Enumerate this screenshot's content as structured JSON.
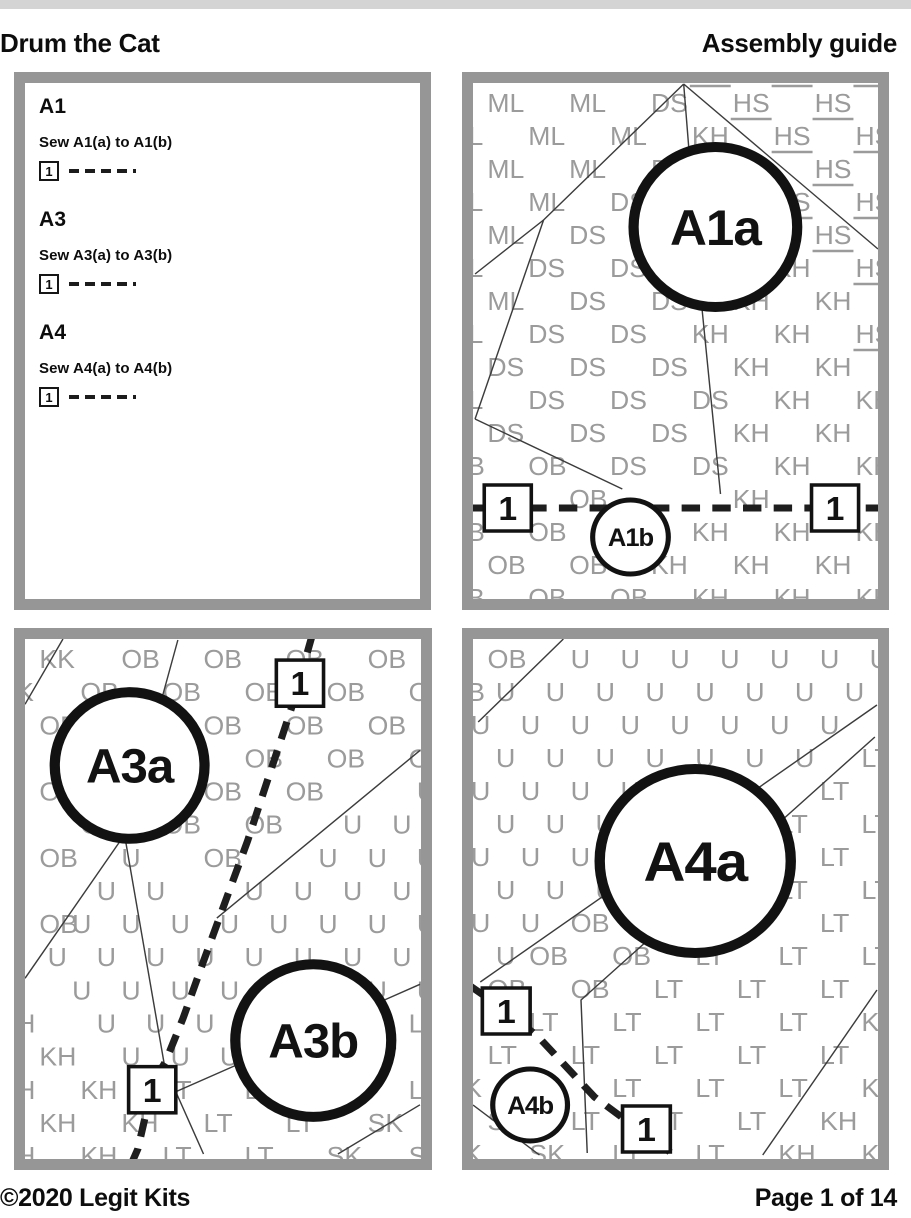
{
  "header": {
    "title": "Drum the Cat",
    "subtitle": "Assembly guide"
  },
  "footer": {
    "copyright": "©2020 Legit Kits",
    "page_indicator": "Page 1 of 14"
  },
  "colors": {
    "panel_border_gray": "#969696",
    "fabric_code_gray": "#9b9b9b",
    "seam_black": "#1e1e1e",
    "top_bar_gray": "#d4d4d4",
    "text_black": "#0d0d0d"
  },
  "instruction_panel": {
    "steps": [
      {
        "title": "A1",
        "text": "Sew A1(a) to A1(b)",
        "seam_number": "1"
      },
      {
        "title": "A3",
        "text": "Sew A3(a) to A3(b)",
        "seam_number": "1"
      },
      {
        "title": "A4",
        "text": "Sew A4(a) to A4(b)",
        "seam_number": "1"
      }
    ]
  },
  "pattern_panels": [
    {
      "id": "A1",
      "view": {
        "w": 396,
        "h": 516
      },
      "regions": [
        {
          "code": "ML",
          "underline": false,
          "poly": [
            [
              -20,
              -20
            ],
            [
              210,
              -20
            ],
            [
              206,
              1
            ],
            [
              69,
              137
            ],
            [
              0,
              336
            ],
            [
              -20,
              336
            ]
          ]
        },
        {
          "code": "DS",
          "underline": false,
          "poly": [
            [
              206,
              1
            ],
            [
              222,
              206
            ],
            [
              242,
              411
            ],
            [
              146,
              406
            ],
            [
              2,
              336
            ],
            [
              69,
              137
            ]
          ]
        },
        {
          "code": "HS",
          "underline": true,
          "poly": [
            [
              206,
              -20
            ],
            [
              416,
              -20
            ],
            [
              416,
              300
            ]
          ]
        },
        {
          "code": "KH",
          "underline": false,
          "poly": [
            [
              216,
              30
            ],
            [
              416,
              300
            ],
            [
              416,
              536
            ],
            [
              180,
              536
            ],
            [
              150,
              436
            ],
            [
              242,
              411
            ],
            [
              222,
              206
            ]
          ]
        },
        {
          "code": "OB",
          "underline": false,
          "poly": [
            [
              -20,
              336
            ],
            [
              0,
              336
            ],
            [
              146,
              406
            ],
            [
              150,
              436
            ],
            [
              180,
              536
            ],
            [
              -20,
              536
            ]
          ]
        }
      ],
      "lines": [
        [
          [
            206,
            1
          ],
          [
            69,
            137
          ],
          [
            2,
            191
          ]
        ],
        [
          [
            69,
            137
          ],
          [
            2,
            336
          ]
        ],
        [
          [
            206,
            1
          ],
          [
            222,
            206
          ],
          [
            242,
            411
          ]
        ],
        [
          [
            206,
            1
          ],
          [
            396,
            166
          ]
        ],
        [
          [
            2,
            336
          ],
          [
            146,
            406
          ]
        ]
      ],
      "dashed": [
        [
          -6,
          425
        ],
        [
          402,
          425
        ]
      ],
      "seam_boxes": [
        {
          "label": "1",
          "cx": 34,
          "cy": 425
        },
        {
          "label": "1",
          "cx": 354,
          "cy": 425
        }
      ],
      "circles": [
        {
          "label": "A1a",
          "cx": 237,
          "cy": 144,
          "r": 80,
          "big": true,
          "font": 50
        },
        {
          "label": "A1b",
          "cx": 154,
          "cy": 454,
          "r": 37,
          "big": false,
          "font": 25
        }
      ]
    },
    {
      "id": "A3",
      "view": {
        "w": 386,
        "h": 518
      },
      "regions": [
        {
          "code": "KK",
          "underline": false,
          "poly": [
            [
              -20,
              -20
            ],
            [
              55,
              -20
            ],
            [
              0,
              80
            ],
            [
              -20,
              80
            ]
          ]
        },
        {
          "code": "OB",
          "underline": false,
          "poly": [
            [
              55,
              -20
            ],
            [
              406,
              -20
            ],
            [
              406,
              111
            ],
            [
              187,
              278
            ],
            [
              97,
              195
            ],
            [
              0,
              330
            ],
            [
              0,
              95
            ]
          ]
        },
        {
          "code": "U",
          "underline": false,
          "poly": [
            [
              97,
              195
            ],
            [
              187,
              278
            ],
            [
              406,
              111
            ],
            [
              406,
              344
            ],
            [
              147,
              451
            ],
            [
              125,
              449
            ],
            [
              0,
              330
            ]
          ]
        },
        {
          "code": "KH",
          "underline": false,
          "poly": [
            [
              0,
              330
            ],
            [
              125,
              449
            ],
            [
              108,
              538
            ],
            [
              -20,
              538
            ],
            [
              -20,
              330
            ]
          ]
        },
        {
          "code": "LT",
          "underline": false,
          "poly": [
            [
              125,
              449
            ],
            [
              147,
              451
            ],
            [
              406,
              344
            ],
            [
              406,
              440
            ],
            [
              295,
              525
            ],
            [
              280,
              538
            ],
            [
              115,
              538
            ]
          ]
        },
        {
          "code": "SK",
          "underline": false,
          "poly": [
            [
              295,
              525
            ],
            [
              406,
              440
            ],
            [
              406,
              538
            ],
            [
              295,
              538
            ]
          ]
        }
      ],
      "lines": [
        [
          [
            37,
            0
          ],
          [
            0,
            65
          ]
        ],
        [
          [
            149,
            1
          ],
          [
            97,
            195
          ]
        ],
        [
          [
            97,
            195
          ],
          [
            0,
            338
          ]
        ],
        [
          [
            97,
            195
          ],
          [
            137,
            431
          ]
        ],
        [
          [
            385,
            111
          ],
          [
            187,
            278
          ]
        ],
        [
          [
            385,
            344
          ],
          [
            147,
            451
          ],
          [
            174,
            513
          ]
        ],
        [
          [
            305,
            513
          ],
          [
            385,
            464
          ]
        ]
      ],
      "dashed": [
        [
          280,
          -4
        ],
        [
          260,
          68
        ],
        [
          235,
          145
        ],
        [
          217,
          201
        ],
        [
          194,
          265
        ],
        [
          174,
          321
        ],
        [
          154,
          378
        ],
        [
          137,
          421
        ],
        [
          125,
          441
        ],
        [
          110,
          508
        ],
        [
          104,
          522
        ]
      ],
      "seam_boxes": [
        {
          "label": "1",
          "cx": 268,
          "cy": 44
        },
        {
          "label": "1",
          "cx": 124,
          "cy": 449
        }
      ],
      "circles": [
        {
          "label": "A3a",
          "cx": 102,
          "cy": 126,
          "r": 73,
          "big": true,
          "font": 48
        },
        {
          "label": "A3b",
          "cx": 281,
          "cy": 400,
          "r": 76,
          "big": true,
          "font": 48
        }
      ]
    },
    {
      "id": "A4",
      "view": {
        "w": 390,
        "h": 520
      },
      "regions": [
        {
          "code": "OB",
          "underline": false,
          "poly": [
            [
              -20,
              -20
            ],
            [
              90,
              -20
            ],
            [
              5,
              83
            ],
            [
              -20,
              83
            ]
          ]
        },
        {
          "code": "U",
          "underline": false,
          "poly": [
            [
              90,
              -20
            ],
            [
              410,
              -20
            ],
            [
              410,
              66
            ],
            [
              7,
              343
            ],
            [
              -20,
              345
            ],
            [
              -20,
              83
            ],
            [
              5,
              83
            ]
          ]
        },
        {
          "code": "OB",
          "underline": false,
          "poly": [
            [
              410,
              66
            ],
            [
              410,
              98
            ],
            [
              304,
              188
            ],
            [
              104,
              361
            ],
            [
              28,
              372
            ],
            [
              7,
              343
            ]
          ]
        },
        {
          "code": "LT",
          "underline": false,
          "poly": [
            [
              28,
              372
            ],
            [
              104,
              361
            ],
            [
              304,
              188
            ],
            [
              410,
              98
            ],
            [
              410,
              340
            ],
            [
              274,
              540
            ],
            [
              110,
              540
            ],
            [
              0,
              420
            ]
          ]
        },
        {
          "code": "KH",
          "underline": false,
          "poly": [
            [
              285,
              540
            ],
            [
              410,
              345
            ],
            [
              410,
              540
            ]
          ]
        },
        {
          "code": "SK",
          "underline": false,
          "poly": [
            [
              -20,
              420
            ],
            [
              110,
              540
            ],
            [
              -20,
              540
            ]
          ]
        }
      ],
      "lines": [
        [
          [
            87,
            0
          ],
          [
            5,
            83
          ]
        ],
        [
          [
            389,
            66
          ],
          [
            7,
            343
          ]
        ],
        [
          [
            387,
            98
          ],
          [
            104,
            361
          ],
          [
            110,
            514
          ]
        ],
        [
          [
            279,
            516
          ],
          [
            389,
            351
          ]
        ],
        [
          [
            0,
            466
          ],
          [
            64,
            516
          ]
        ]
      ],
      "dashed": [
        [
          -4,
          346
        ],
        [
          32,
          372
        ],
        [
          63,
          398
        ],
        [
          90,
          428
        ],
        [
          117,
          458
        ],
        [
          143,
          478
        ],
        [
          167,
          489
        ],
        [
          196,
          520
        ]
      ],
      "seam_boxes": [
        {
          "label": "1",
          "cx": 32,
          "cy": 372
        },
        {
          "label": "1",
          "cx": 167,
          "cy": 490
        }
      ],
      "circles": [
        {
          "label": "A4a",
          "cx": 214,
          "cy": 222,
          "r": 92,
          "big": true,
          "font": 56
        },
        {
          "label": "A4b",
          "cx": 55,
          "cy": 466,
          "r": 36,
          "big": false,
          "font": 25
        }
      ]
    }
  ]
}
